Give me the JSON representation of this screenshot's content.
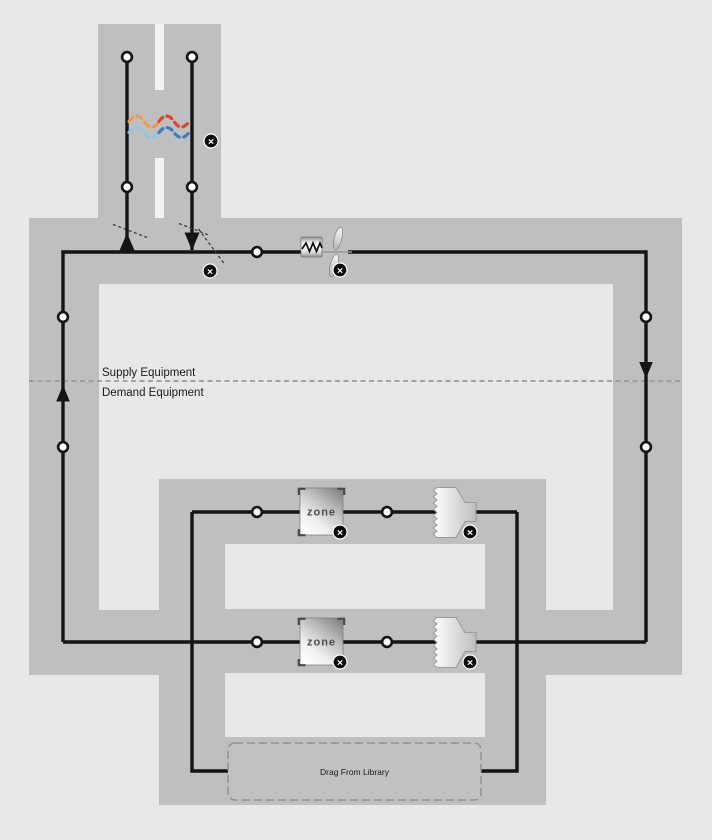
{
  "canvas": {
    "labels": {
      "supply_equipment": "Supply Equipment",
      "demand_equipment": "Demand Equipment",
      "drop_zone": "Drag From Library",
      "zone": "zone"
    },
    "icons": {
      "delete_glyph": "×",
      "node": "connection-node-circle",
      "heating_coil": "zigzag-coil",
      "fan": "two-blade-fan",
      "heat_exchanger_waves": "dashed-sine-waves",
      "diffuser": "sawtooth-funnel"
    },
    "colors": {
      "background": "#e8e8e8",
      "duct_band": "#bfbfbf",
      "duct_slot": "#f2f2f2",
      "line": "#141414",
      "divider": "#9b9b9b",
      "hx_warm_start": "#f09a50",
      "hx_warm_end": "#e0432f",
      "hx_cool_start": "#8ec6e6",
      "hx_cool_end": "#3f80b8"
    }
  }
}
